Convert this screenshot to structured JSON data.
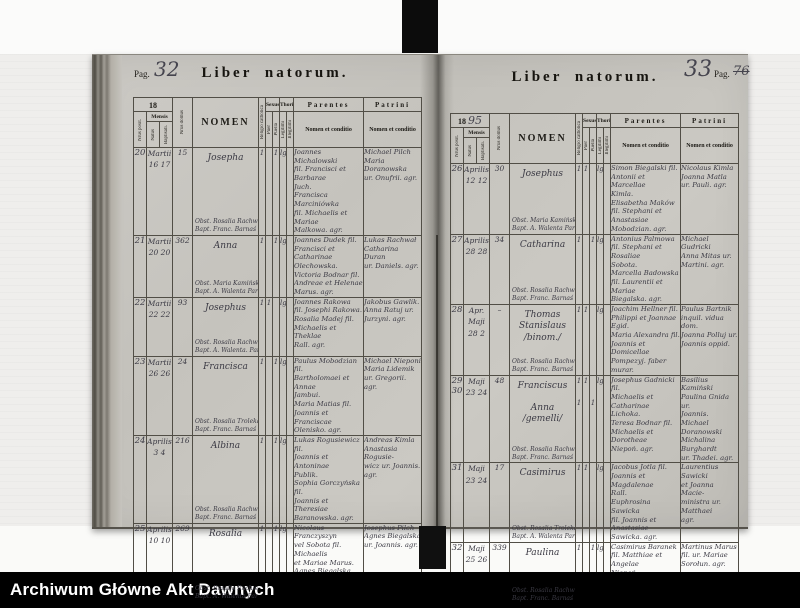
{
  "footer": {
    "archive_label": "Archiwum Główne Akt Dawnych"
  },
  "table_header": {
    "nrus_positi": "Nrus posit.",
    "mensis": "Mensis",
    "natus": "Natus",
    "baptisati": "Baptisati.",
    "nrus_domus": "Nrus domus",
    "nomen": "NOMEN",
    "religio": "Religio catholica",
    "sexus": "Sexus",
    "puer": "Puer",
    "puella": "Puella",
    "thori": "Thori",
    "legitimi": "Legitimi",
    "illegitimi": "Illegitimi",
    "parentes": "Parentes",
    "patrini": "Patrini",
    "nomen_et_conditio": "Nomen et conditio"
  },
  "book": {
    "left_page": {
      "pag_label": "Pag.",
      "pag_number_hw": "32",
      "title": "Liber natorum.",
      "year_printed": "18",
      "year_hw": "",
      "rows": [
        {
          "nr": "20",
          "mensis": "Martii\n16  17",
          "domus": "15",
          "name": "Josepha",
          "obst_note": "Obst. Rosalia Rachwał\nBapt. Franc. Barnaś Coop.",
          "religio": "1",
          "puer": "",
          "puella": "1",
          "legitimi": "lg",
          "illegitimi": "",
          "parentes": "Joannes Michalowski\nfil. Francisci et Barbarae\nJuch.\nFrancisca Marciniówka\nfil. Michaelis et Mariae\nMalkowa. agr.",
          "patrini": "Michael Pilch\nMaria Doranowska\nur. Onufrii. agr."
        },
        {
          "nr": "21",
          "mensis": "Martii\n20  20",
          "domus": "362",
          "name": "Anna",
          "obst_note": "Obst. Maria Kamińska\nBapt. A. Walenta Paroch.",
          "religio": "1",
          "puer": "",
          "puella": "1",
          "legitimi": "lg",
          "illegitimi": "",
          "parentes": "Joannes Dudek fil.\nFrancisci et Catharinae\nOlechowska.\nVictoria Bodnar fil.\nAndreae et Helenae\nMarus. agr.",
          "patrini": "Lukas Rachwał\nCatharina Duran\nur. Daniels. agr."
        },
        {
          "nr": "22",
          "mensis": "Martii\n22  22",
          "domus": "93",
          "name": "Josephus",
          "obst_note": "Obst. Rosalia Rachwał\nBapt. A. Walenta. Paroch.",
          "religio": "1",
          "puer": "1",
          "puella": "",
          "legitimi": "lg",
          "illegitimi": "",
          "parentes": "Joannes Rakowa\nfil. Josephi Rakowa.\nRosalia Madej fil.\nMichaelis et Theklae\nRall. agr.",
          "patrini": "Jakobus Gawlik.\nAnna Ratuj ur.\nJurzyni. agr."
        },
        {
          "nr": "23",
          "mensis": "Martii\n26  26",
          "domus": "24",
          "name": "Francisca",
          "obst_note": "Obst. Rosalia Troleka\nBapt. Franc. Barnaś Coop.",
          "religio": "1",
          "puer": "",
          "puella": "1",
          "legitimi": "lg",
          "illegitimi": "",
          "parentes": "Paulus Mobodzian fil.\nBartholomaei et Annae\nJambui.\nMaria Matias fil.\nJoannis et Franciscae\nOlenisko. agr.",
          "patrini": "Michael Nieponi\nMaria Lidemik\nur. Gregorii. agr."
        },
        {
          "nr": "24",
          "mensis": "Aprilis\n3  4",
          "domus": "216",
          "name": "Albina",
          "obst_note": "Obst. Rosalia Rachwał\nBapt. Franc. Barnaś Coop.",
          "religio": "1",
          "puer": "",
          "puella": "1",
          "legitimi": "lg",
          "illegitimi": "",
          "parentes": "Lukas Rogusiewicz fil.\nJoannis et Antoninae\nPublik.\nSophia Gorczyńska fil.\nJoannis et Theresiae\nBaranowska. agr.",
          "patrini": "Andreas Kimla\nAnastasia Rogusie-\nwicz ur. Joannis.\nagr."
        },
        {
          "nr": "25",
          "mensis": "Aprilis\n10  10",
          "domus": "269",
          "name": "Rosalia",
          "obst_note": "Obst. Rosalia Rachwał\nBapt. A. Walenta Paroch.",
          "religio": "1",
          "puer": "",
          "puella": "1",
          "legitimi": "lg",
          "illegitimi": "",
          "parentes": "Nicolaus Franczyszyn\nvel Sobota fil. Michaelis\net Mariae Marus.\nAgnes Biegalska\nfil. Andreae et Agnetis\nSulimska. agr.",
          "patrini": "Josephus Pilch\nAgnes Biegalska\nur. Joannis. agr."
        }
      ]
    },
    "right_page": {
      "pag_label": "Pag.",
      "pag_number_hw": "33",
      "pag_number_printed_struck": "76",
      "title": "Liber natorum.",
      "year_printed": "18",
      "year_hw": "95",
      "rows": [
        {
          "nr": "26",
          "mensis": "Aprilis\n12  12",
          "domus": "30",
          "name": "Josephus",
          "obst_note": "Obst. Maria Kamińska\nBapt. A. Walenta Paroch.",
          "religio": "1",
          "puer": "1",
          "puella": "",
          "legitimi": "lg",
          "illegitimi": "",
          "parentes": "Simon Biegalski fil.\nAntonii et Marcellae\nKimla.\nElisabetha Maków\nfil. Stephani et Anastasiae\nMobodzian. agr.",
          "patrini": "Nicolaus Kimla\nJoanna Matla\nur. Pauli. agr."
        },
        {
          "nr": "27",
          "mensis": "Aprilis\n28  28",
          "domus": "34",
          "name": "Catharina",
          "obst_note": "Obst. Rosalia Rachwał\nBapt. Franc. Barnaś Coop.",
          "religio": "1",
          "puer": "",
          "puella": "1",
          "legitimi": "lg",
          "illegitimi": "",
          "parentes": "Antonius Palmowa\nfil. Stephani et Rosaliae\nSobota.\nMarcella Badowska\nfil. Laurentii et Mariae\nBiegalska. agr.",
          "patrini": "Michael Gudricki\nAnna Mitas ur.\nMartini. agr."
        },
        {
          "nr": "28",
          "mensis": "Apr. Maji\n28  2",
          "domus": "–",
          "name": "Thomas Stanislaus\n/binom./",
          "obst_note": "Obst. Rosalia Rachwał\nBapt. Franc. Barnaś Coop.",
          "religio": "1",
          "puer": "1",
          "puella": "",
          "legitimi": "lg",
          "illegitimi": "",
          "parentes": "Joachim Hellner fil.\nPhilippi et Joannae Egid.\nMaria Alexandra fil.\nJoannis et Domicellae\nPompezyj. faber murar.",
          "patrini": "Paulus Bartnik\ninquil. vidua dom.\nJoanna Polluj ur.\nJoannis oppid."
        },
        {
          "nr": "29\n30",
          "mensis": "Maji\n23  24",
          "domus": "48",
          "name": "Franciscus\n\nAnna\n/gemelli/",
          "obst_note": "Obst. Rosalia Rachwał.\nBapt. Franc. Barnaś Coop.",
          "religio": "1\n\n1",
          "puer": "1",
          "puella": "\n\n1",
          "legitimi": "lg",
          "illegitimi": "",
          "parentes": "Josephus Gadnicki fil.\nMichaelis et Catharinae\nLichoka.\nTeresa Bodnar fil.\nMichaelis et Dorotheae\nNiepoń. agr.",
          "patrini": "Basilius Kamiński\nPaulina Gnida ur.\nJoannis.\nMichael Doranowski\nMichalina Burghardt\nur. Thadei. agr."
        },
        {
          "nr": "31",
          "mensis": "Maji\n23  24",
          "domus": "17",
          "name": "Casimirus",
          "obst_note": "Obst. Rosalia Troleka\nBapt. A. Walenta Paroch.",
          "religio": "1",
          "puer": "1",
          "puella": "",
          "legitimi": "lg",
          "illegitimi": "",
          "parentes": "Jacobus Jotla fil.\nJoannis et Magdalenae\nRall.\nEuphrosina Sawicka\nfil. Joannis et Anastasiae\nSawicka. agr.",
          "patrini": "Laurentius Sawicki\net Joanna Macie-\nministra ur. Matthaei\nagr."
        },
        {
          "nr": "32",
          "mensis": "Maji\n25  26",
          "domus": "339",
          "name": "Paulina",
          "obst_note": "Obst. Rosalia Rachwał\nBapt. Franc. Barnaś Coop.",
          "religio": "1",
          "puer": "",
          "puella": "1",
          "legitimi": "lg",
          "illegitimi": "",
          "parentes": "Casimirus Baranek\nfil. Matthiae et Angelae\nNiepoń.\nMaria Nawrocka\nfil. Petri et Mariae\nOlenko. agr.",
          "patrini": "Martinus Marus\nfil. ur. Mariae\nSorołun. agr."
        }
      ]
    }
  }
}
